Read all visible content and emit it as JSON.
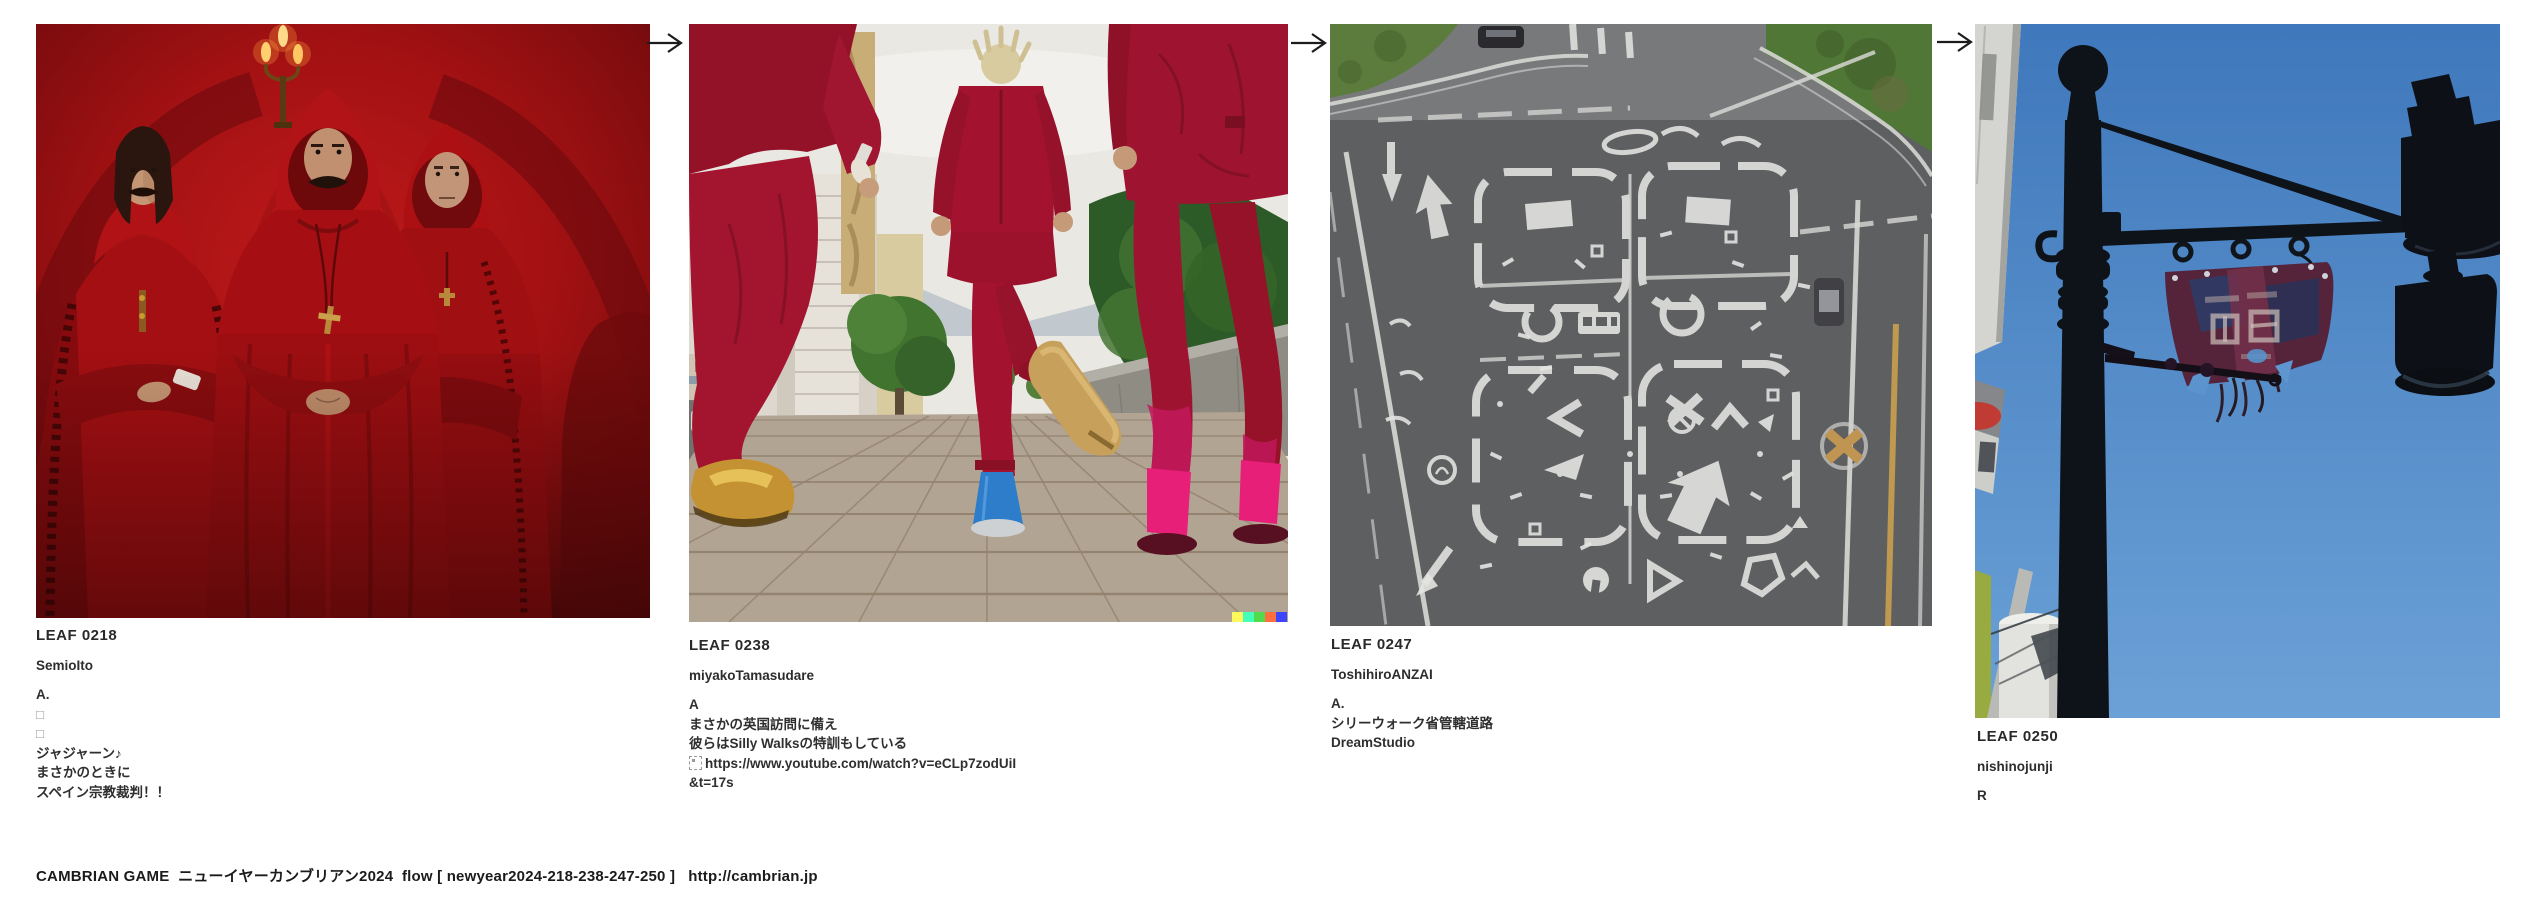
{
  "page": {
    "background": "#ffffff"
  },
  "gallery": {
    "flow_arrow_symbol": "→",
    "watermark_colors": [
      "#fff95b",
      "#43ffb9",
      "#51da4c",
      "#ff6e3c",
      "#3c46ff"
    ],
    "leaves": [
      {
        "id": "LEAF 0218",
        "author": "SemioIto",
        "lines": [
          "A.",
          "□",
          "□",
          "ジャジャーン♪",
          "まさかのときに",
          "スペイン宗教裁判！！"
        ],
        "alt": "Three men in red hooded inquisition robes in a red room with a candelabra"
      },
      {
        "id": "LEAF 0238",
        "author": "miyakoTamasudare",
        "lines": [
          "A",
          "まさかの英国訪問に備え",
          "彼らはSilly Walksの特訓もしている",
          "https://www.youtube.com/watch?v=eCLp7zodUiI",
          "&t=17s"
        ],
        "alt": "Three people in crimson suits doing silly walks along a sidewalk"
      },
      {
        "id": "LEAF 0247",
        "author": "ToshihiroANZAI",
        "lines": [
          "A.",
          "シリーウォーク省管轄道路",
          "DreamStudio"
        ],
        "alt": "Aerial view of an asphalt road covered with chaotic white traffic markings"
      },
      {
        "id": "LEAF 0250",
        "author": "nishinojunji",
        "lines": [
          "R"
        ],
        "alt": "Black street lamp post with a tattered banner against a blue sky"
      }
    ]
  },
  "footer": {
    "text": "CAMBRIAN GAME  ニューイヤーカンブリアン2024  flow [ newyear2024-218-238-247-250 ]   http://cambrian.jp"
  }
}
